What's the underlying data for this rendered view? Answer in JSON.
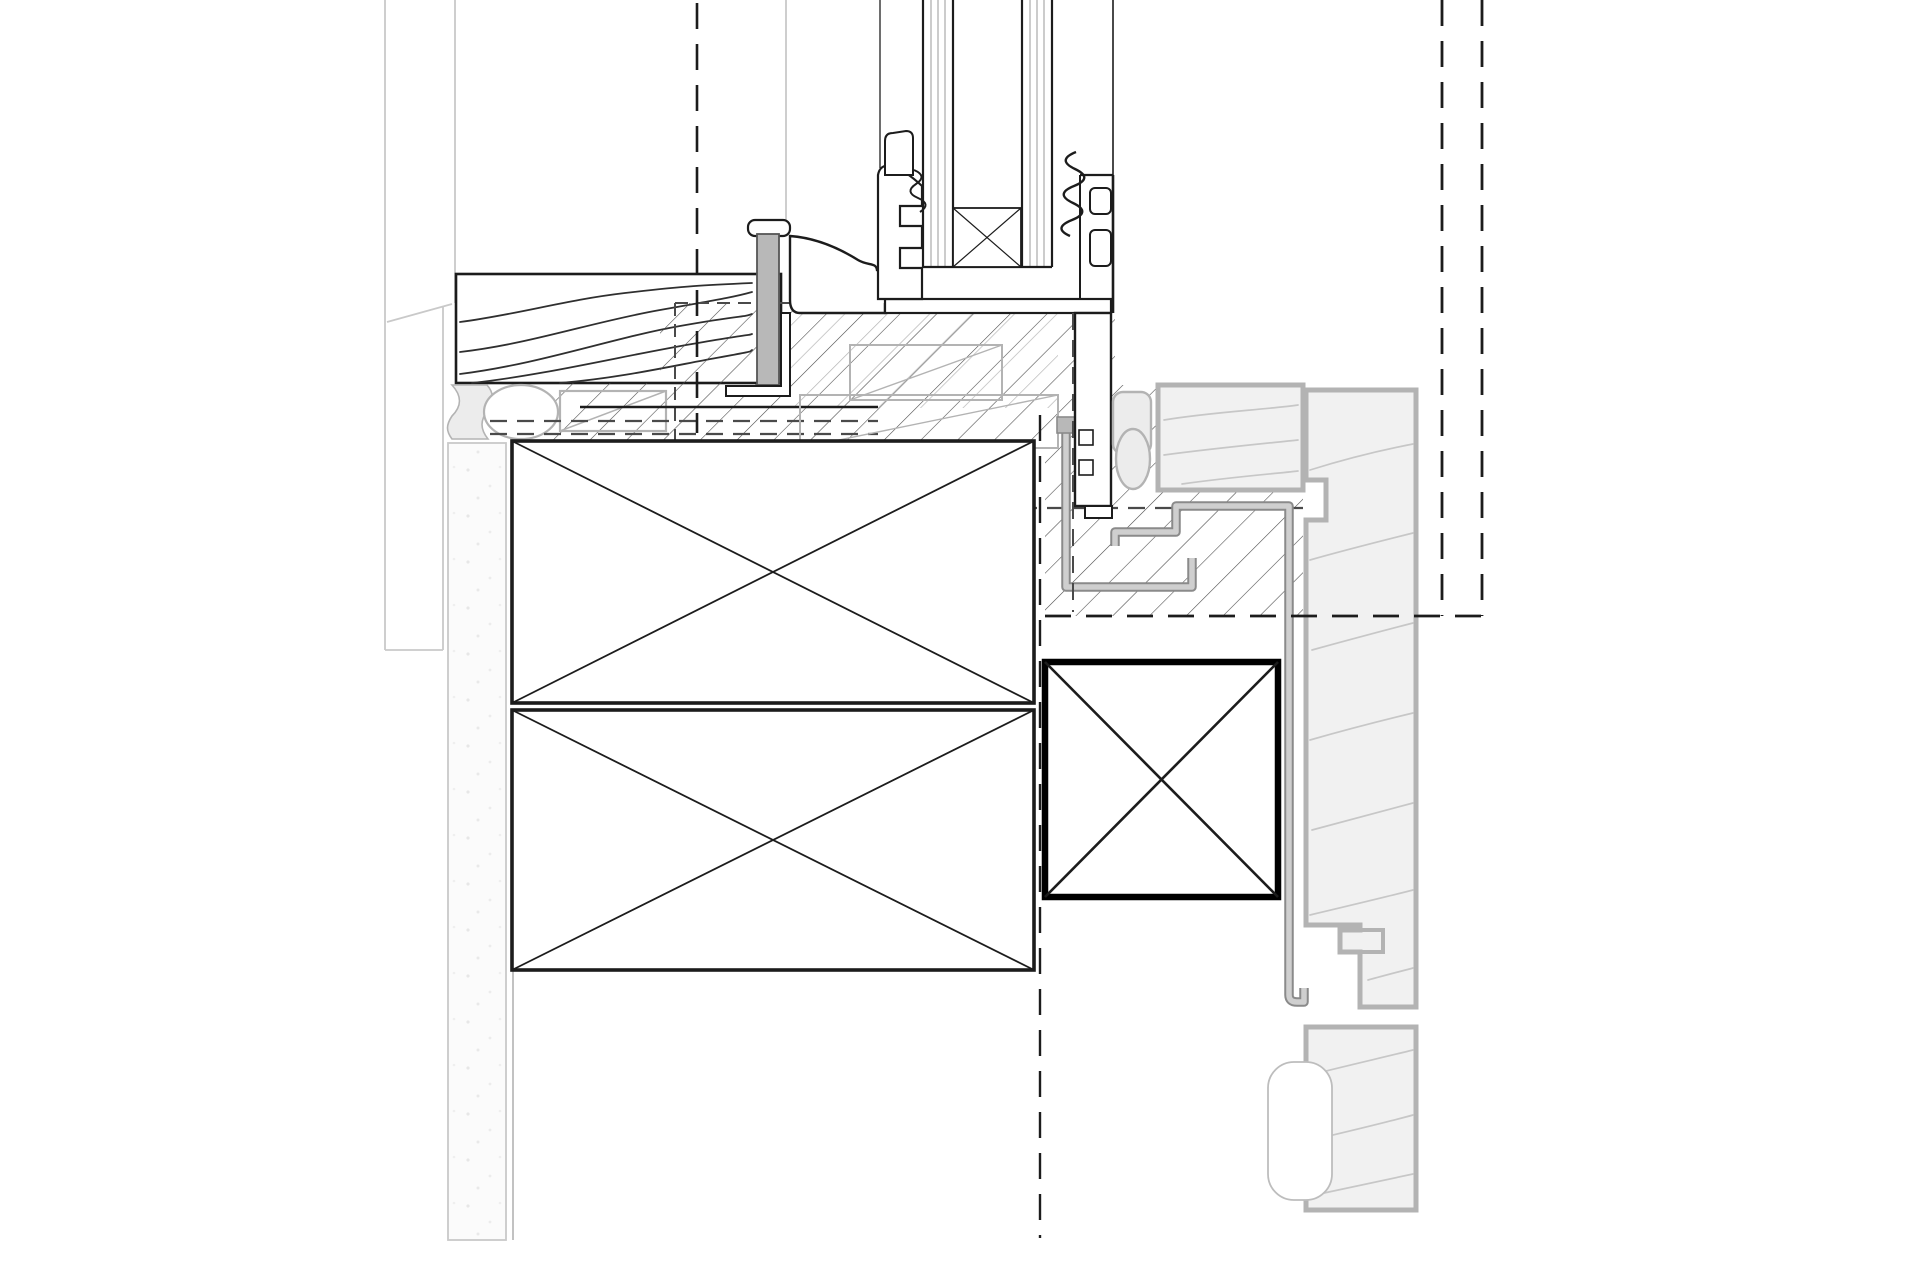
{
  "drawing": {
    "type": "architectural-section-detail",
    "subject": "window-sill-to-timber-facade-junction",
    "orientation": "vertical-section",
    "visible_text": [],
    "components": [
      {
        "name": "glazing-unit",
        "desc": "double glazing panes with crossed edge-spacer box"
      },
      {
        "name": "aluminum-frame",
        "desc": "aluminium window frame sill profile with glazing bead, gaskets and anchor"
      },
      {
        "name": "interior-sill-board",
        "desc": "timber interior window board shown with wood-grain hatch"
      },
      {
        "name": "sealant-joint",
        "desc": "sealant bead with round backer rod below sill board"
      },
      {
        "name": "insulation-hatch",
        "desc": "diagonal-hatched insulation zones around frame"
      },
      {
        "name": "timber-blocking",
        "desc": "two stacked crossed-diagonal blocking boxes"
      },
      {
        "name": "structural-blocking",
        "desc": "bold-outlined crossed blocking box at right"
      },
      {
        "name": "support-bracket",
        "desc": "grey L-shaped support bracket"
      },
      {
        "name": "metal-flashing",
        "desc": "grey stepped sheet-metal flashing with drip end"
      },
      {
        "name": "foam-gasket",
        "desc": "compressible gasket strip with round bulb"
      },
      {
        "name": "horizontal-batten",
        "desc": "horizontal timber batten cross-section"
      },
      {
        "name": "vertical-cladding",
        "desc": "profiled vertical timber cladding boards"
      },
      {
        "name": "plaster-strip",
        "desc": "interior plasterboard strip"
      },
      {
        "name": "air-seal-membrane",
        "desc": "solid and dashed membrane seal lines"
      },
      {
        "name": "reference-lines",
        "desc": "dashed setting-out / beyond reference lines"
      }
    ]
  },
  "colors": {
    "black": "#1c1c1c",
    "dark": "#4a4a4a",
    "gray": "#b3b3b3",
    "lightline": "#c9c9c9",
    "grain": "#2f2f2f",
    "grainlight": "#c7c7c7",
    "metal": "#b8b8b8",
    "panel": "#f1f1f1",
    "seal": "#ececec",
    "flashout": "#8a8a8a",
    "flashin": "#cfcfcf",
    "hatch": "#4a4a4a",
    "hatchlight": "#b5b5b5",
    "speckbg": "#fbfbfb",
    "paper": "#ffffff"
  }
}
